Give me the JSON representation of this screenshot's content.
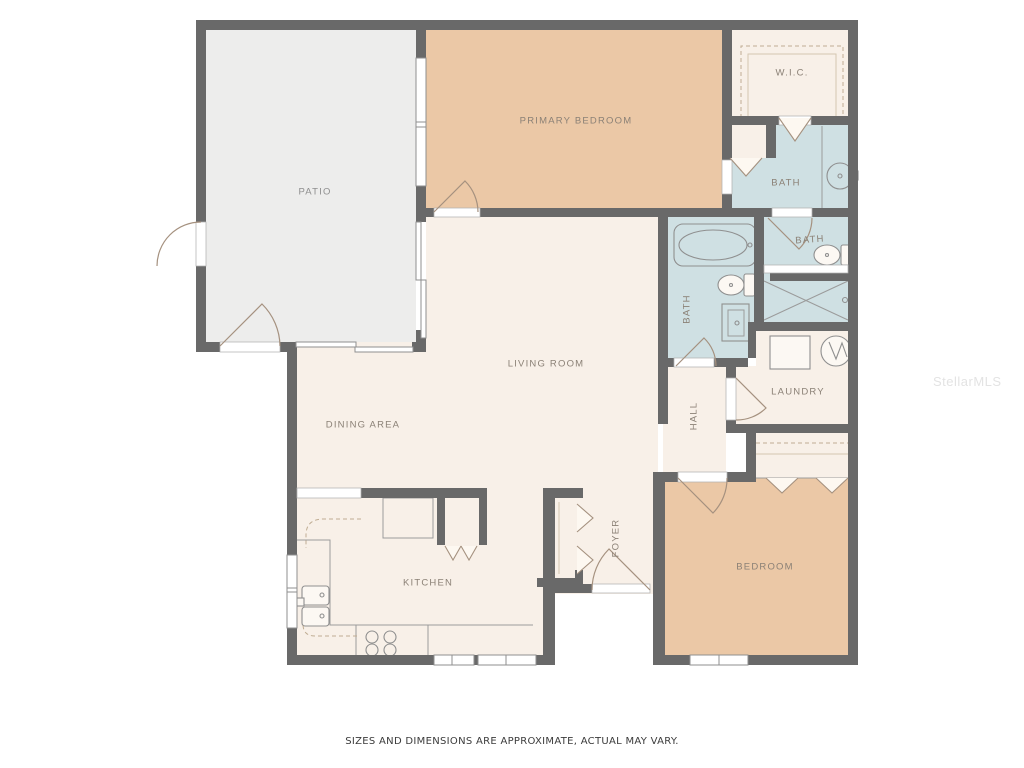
{
  "page": {
    "disclaimer": "SIZES AND DIMENSIONS ARE APPROXIMATE, ACTUAL MAY VARY.",
    "watermark": "StellarMLS"
  },
  "palette": {
    "wall": "#696969",
    "floor_cream": "#f8f0e8",
    "floor_tan": "#ebc8a6",
    "floor_blue": "#cfe0e3",
    "floor_patio_gray": "#ededec",
    "label_text": "#8b8176",
    "door_stroke": "#a5917f",
    "fixture_stroke": "#8f8f8f",
    "disclaimer_text": "#3b3b3b",
    "watermark_text": "#e3e3e3"
  },
  "rooms": {
    "patio": {
      "label": "PATIO"
    },
    "primary_bedroom": {
      "label": "PRIMARY BEDROOM"
    },
    "wic": {
      "label": "W.I.C."
    },
    "primary_bath": {
      "label": "BATH"
    },
    "bath2": {
      "label": "BATH"
    },
    "hall_bath": {
      "label": "BATH"
    },
    "hall": {
      "label": "HALL"
    },
    "laundry": {
      "label": "LAUNDRY"
    },
    "living_room": {
      "label": "LIVING ROOM"
    },
    "dining_area": {
      "label": "DINING AREA"
    },
    "kitchen": {
      "label": "KITCHEN"
    },
    "foyer": {
      "label": "FOYER"
    },
    "bedroom": {
      "label": "BEDROOM"
    }
  }
}
